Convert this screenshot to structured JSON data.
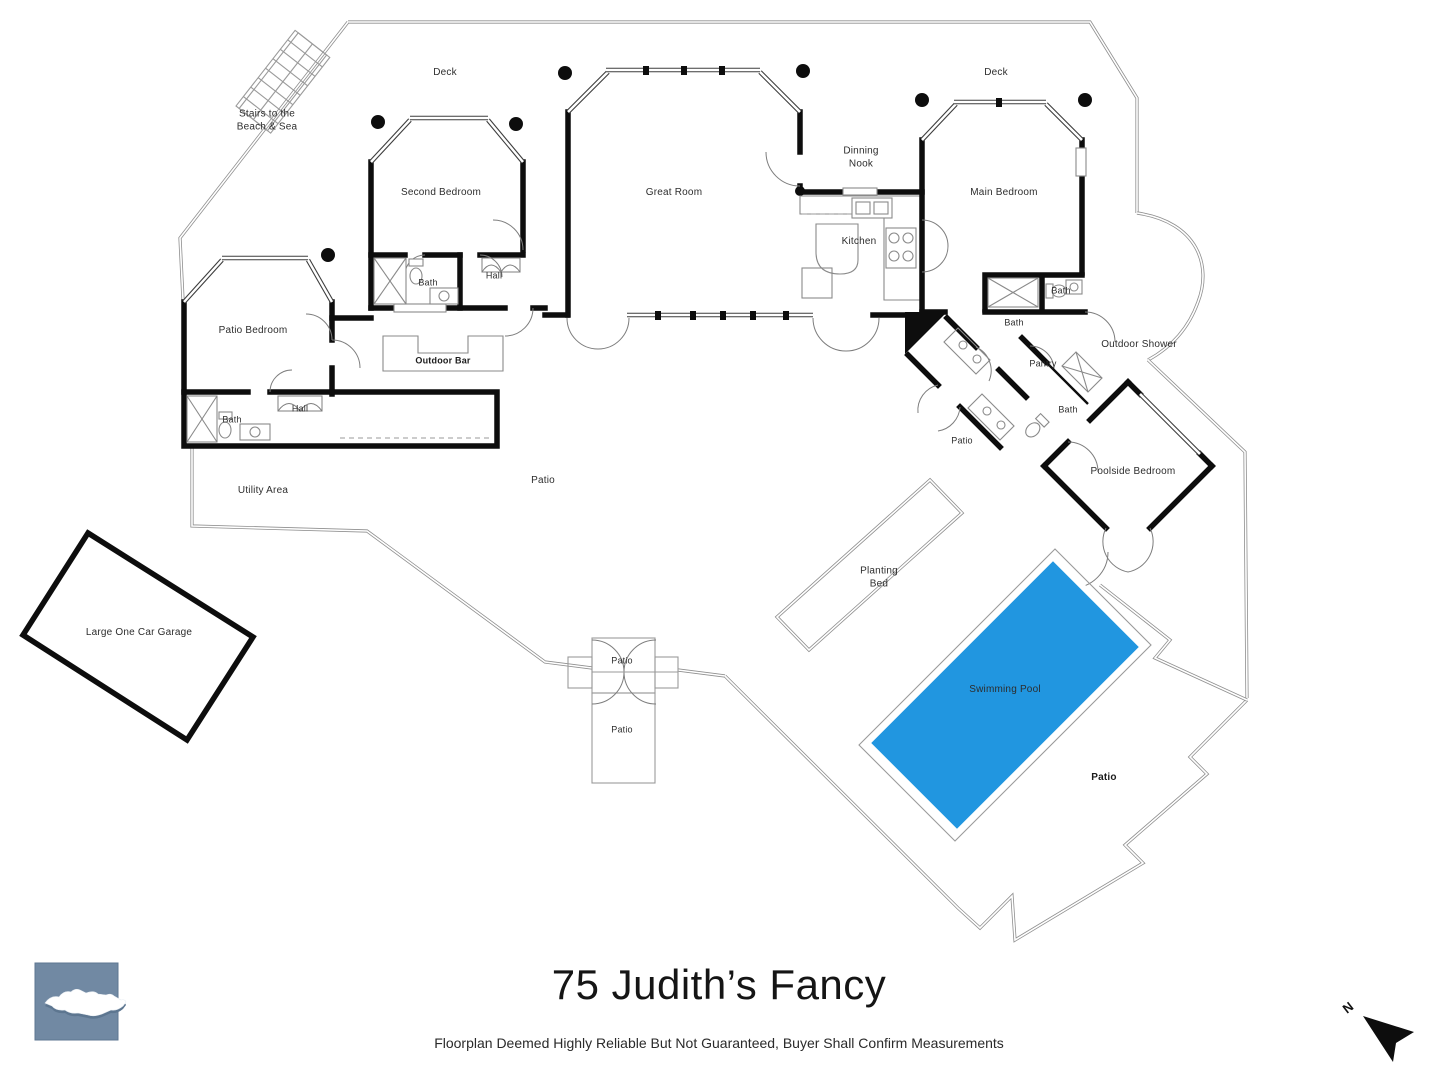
{
  "title": "75 Judith’s Fancy",
  "disclaimer": "Floorplan Deemed Highly Reliable But Not Guaranteed, Buyer Shall Confirm Measurements",
  "compass": {
    "label": "N"
  },
  "logo": {
    "name": "st-croix-island-logo",
    "bg": "#7189a3",
    "island": "#ffffff",
    "shadow": "#5d7690"
  },
  "colors": {
    "pool": "#2196e0",
    "wall": "#0d0d0d",
    "thin_line": "#9a9a9a"
  },
  "floorplan": {
    "labels": [
      {
        "name": "deck-left",
        "text": "Deck",
        "x": 445,
        "y": 73
      },
      {
        "name": "stairs-to-beach",
        "text": "Stairs to the\nBeach & Sea",
        "x": 267,
        "y": 121
      },
      {
        "name": "second-bedroom",
        "text": "Second Bedroom",
        "x": 441,
        "y": 193
      },
      {
        "name": "great-room",
        "text": "Great Room",
        "x": 674,
        "y": 193
      },
      {
        "name": "dinning-nook",
        "text": "Dinning\nNook",
        "x": 861,
        "y": 158
      },
      {
        "name": "deck-right",
        "text": "Deck",
        "x": 996,
        "y": 73
      },
      {
        "name": "main-bedroom",
        "text": "Main Bedroom",
        "x": 1004,
        "y": 193
      },
      {
        "name": "kitchen",
        "text": "Kitchen",
        "x": 859,
        "y": 242
      },
      {
        "name": "bath-second",
        "text": "Bath",
        "x": 428,
        "y": 283,
        "size": "small"
      },
      {
        "name": "hall-second",
        "text": "Hall",
        "x": 494,
        "y": 276,
        "size": "small"
      },
      {
        "name": "patio-bedroom",
        "text": "Patio Bedroom",
        "x": 253,
        "y": 331
      },
      {
        "name": "outdoor-bar",
        "text": "Outdoor Bar",
        "x": 443,
        "y": 361,
        "size": "small",
        "bold": true
      },
      {
        "name": "bath-patio",
        "text": "Bath",
        "x": 232,
        "y": 420,
        "size": "small"
      },
      {
        "name": "hall-patio",
        "text": "Hall",
        "x": 300,
        "y": 409,
        "size": "small"
      },
      {
        "name": "utility-area",
        "text": "Utility Area",
        "x": 263,
        "y": 491
      },
      {
        "name": "patio-main",
        "text": "Patio",
        "x": 543,
        "y": 481
      },
      {
        "name": "bath-main-upper",
        "text": "Bath",
        "x": 1061,
        "y": 291,
        "size": "small"
      },
      {
        "name": "bath-main",
        "text": "Bath",
        "x": 1014,
        "y": 323,
        "size": "small"
      },
      {
        "name": "outdoor-shower",
        "text": "Outdoor Shower",
        "x": 1139,
        "y": 345
      },
      {
        "name": "pantry",
        "text": "Pantry",
        "x": 1043,
        "y": 364,
        "size": "small"
      },
      {
        "name": "bath-poolside",
        "text": "Bath",
        "x": 1068,
        "y": 410,
        "size": "small"
      },
      {
        "name": "patio-corridor",
        "text": "Patio",
        "x": 962,
        "y": 441,
        "size": "small"
      },
      {
        "name": "poolside-bedroom",
        "text": "Poolside Bedroom",
        "x": 1133,
        "y": 472
      },
      {
        "name": "planting-bed",
        "text": "Planting\nBed",
        "x": 879,
        "y": 578
      },
      {
        "name": "swimming-pool",
        "text": "Swimming Pool",
        "x": 1005,
        "y": 690
      },
      {
        "name": "patio-pool",
        "text": "Patio",
        "x": 1104,
        "y": 778,
        "bold": true
      },
      {
        "name": "patio-gate-upper",
        "text": "Patio",
        "x": 622,
        "y": 661,
        "size": "small"
      },
      {
        "name": "patio-gate-lower",
        "text": "Patio",
        "x": 622,
        "y": 730,
        "size": "small"
      },
      {
        "name": "garage",
        "text": "Large One Car Garage",
        "x": 139,
        "y": 633
      }
    ]
  }
}
